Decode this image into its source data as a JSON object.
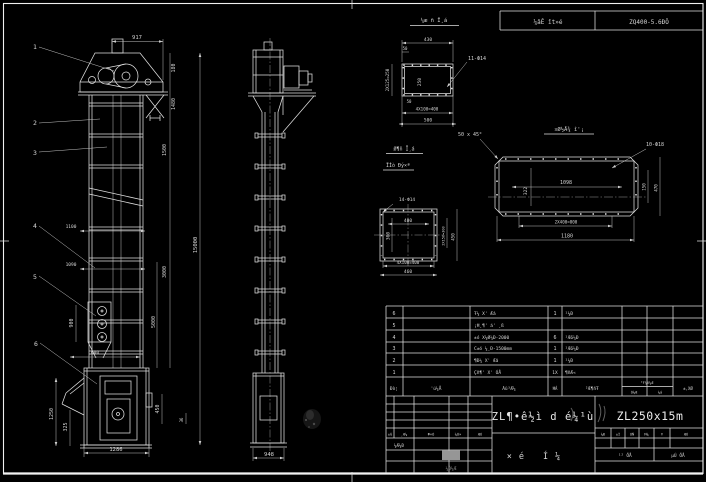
{
  "sheet": {
    "bg": "#000000",
    "line": "#e0e0e0"
  },
  "header": {
    "left": "¼âÊ ît»é",
    "right": "ZQ400-5.6ÐÖ"
  },
  "balloons": [
    "1",
    "2",
    "3",
    "4",
    "5",
    "6"
  ],
  "front_view": {
    "dims": {
      "top": "917",
      "h1": "180",
      "h2": "1480",
      "h3": "1500",
      "overall": "15000",
      "h4": "3000",
      "h5": "5000",
      "w1": "1100",
      "w2": "1090",
      "p1": "900",
      "p2": "600",
      "b1": "1250",
      "b2": "325",
      "b3": "450",
      "b4": "36",
      "base": "1286"
    }
  },
  "side_view": {
    "dims": {
      "base": "948"
    }
  },
  "detail_top": {
    "title": "¼æ ñ Ī¸á",
    "holes": "11-Ф14",
    "dims": {
      "w": "430",
      "t50": "50",
      "side": "2X125=250",
      "inner": "250",
      "s50": "50",
      "b1": "4X100=400",
      "b2": "500"
    }
  },
  "detail_outlet": {
    "title": "¤Ø½Å¾ î'¡",
    "chamfer": "50 x 45°",
    "holes": "10-Ф18",
    "dims": {
      "inner_w": "1098",
      "inner_h": "322",
      "r1": "150",
      "r2": "470",
      "b1": "2X400=800",
      "b2": "1180"
    }
  },
  "detail_inlet": {
    "title1": "Ø¶ñ Ī¸á",
    "title2": "ÏÍò Ðý×ª",
    "holes": "14-Ф14",
    "dims": {
      "inner_w": "400",
      "inner_h": "300",
      "r1": "2X150=300",
      "r2": "450",
      "b1": "4X100=400",
      "b2": "460"
    }
  },
  "bom": {
    "headers": {
      "no": "Ðò¦",
      "code": "'ú¼Å",
      "name": "Ãû³Æ¼",
      "qty": "ĦÁ",
      "mat": "²Æ¶ñŦ",
      "wt": "¹Ŧ¼X¼Æ",
      "w1": "Ó¼Æ",
      "w2": "¼á",
      "rem": "±,XØ"
    },
    "rows": [
      {
        "no": "6",
        "code": "",
        "name": "Ŧ¼ X' Æâ",
        "qty": "1",
        "mat": "¹¼Ð"
      },
      {
        "no": "5",
        "code": "",
        "name": "¡Ħ¸¶' á' ¸ß",
        "qty": "",
        "mat": ""
      },
      {
        "no": "4",
        "code": "",
        "name": "±ó X¼Ø¼Ð-2000",
        "qty": "6",
        "mat": "¹Æ6¼Ð"
      },
      {
        "no": "3",
        "code": "",
        "name": "C±ó ¼¸Ð-1500mm",
        "qty": "1",
        "mat": "¹Æ6¼Ð"
      },
      {
        "no": "2",
        "code": "",
        "name": "¶Ð¼ X' Æâ",
        "qty": "1",
        "mat": "¹¼Ð"
      },
      {
        "no": "1",
        "code": "",
        "name": "Çñ¶' X' ÓÅ",
        "qty": "1X",
        "mat": "¶ñÆ«"
      }
    ]
  },
  "title_block": {
    "title": "ZL¶•ê½ì d é¼¹ù",
    "subtitle": "×é Í¼",
    "model": "ZL250x15m",
    "rev": [
      "±Ǧ",
      "¸Æ¼",
      "Ф×Ó",
      "¼Ó×",
      "ÆÚ"
    ],
    "sig": "¼Æ¼Ð",
    "gray_note": "¼Ó¼Æ",
    "right_cells": [
      "¼Ð",
      "±Ì",
      "ÓÑ",
      "Ħ¼",
      "Ŧ",
      "ÆÚ"
    ],
    "sheet_total": "¹²  ÕÅ",
    "sheet_no": "µÚ  ÕÅ"
  }
}
